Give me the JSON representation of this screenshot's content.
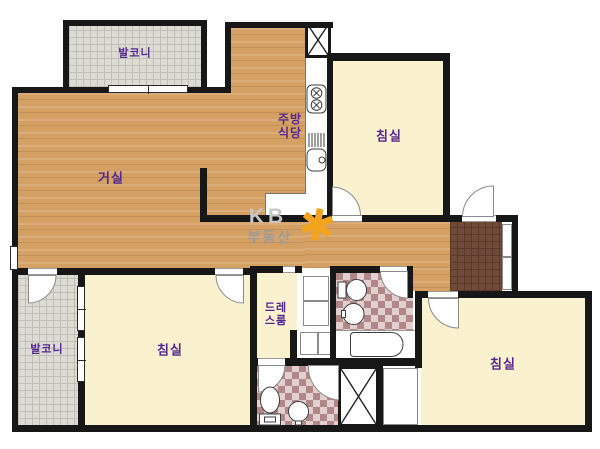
{
  "rooms": {
    "balcony_top": "발코니",
    "living": "거실",
    "kitchen_dining": "주방\n식당",
    "bedroom_top_right": "침실",
    "balcony_bottom": "발코니",
    "bedroom_bottom_left": "침실",
    "dress_room": "드레\n스룸",
    "bedroom_bottom_right": "침실"
  },
  "watermark": {
    "brand": "KB",
    "sub": "부동산",
    "star": "✱"
  },
  "colors": {
    "wood": "#d5a063",
    "cream": "#faf2cf",
    "balcony": "#dcdcd4",
    "tile": "#b18787",
    "tile-light": "#e2cfcf",
    "entry": "#6f4a39",
    "wall": "#171717",
    "label": "#54278f",
    "wm-gray": "#c6c6c6",
    "wm-sub": "#9a9a9a",
    "wm-orange": "#f2a41e"
  }
}
